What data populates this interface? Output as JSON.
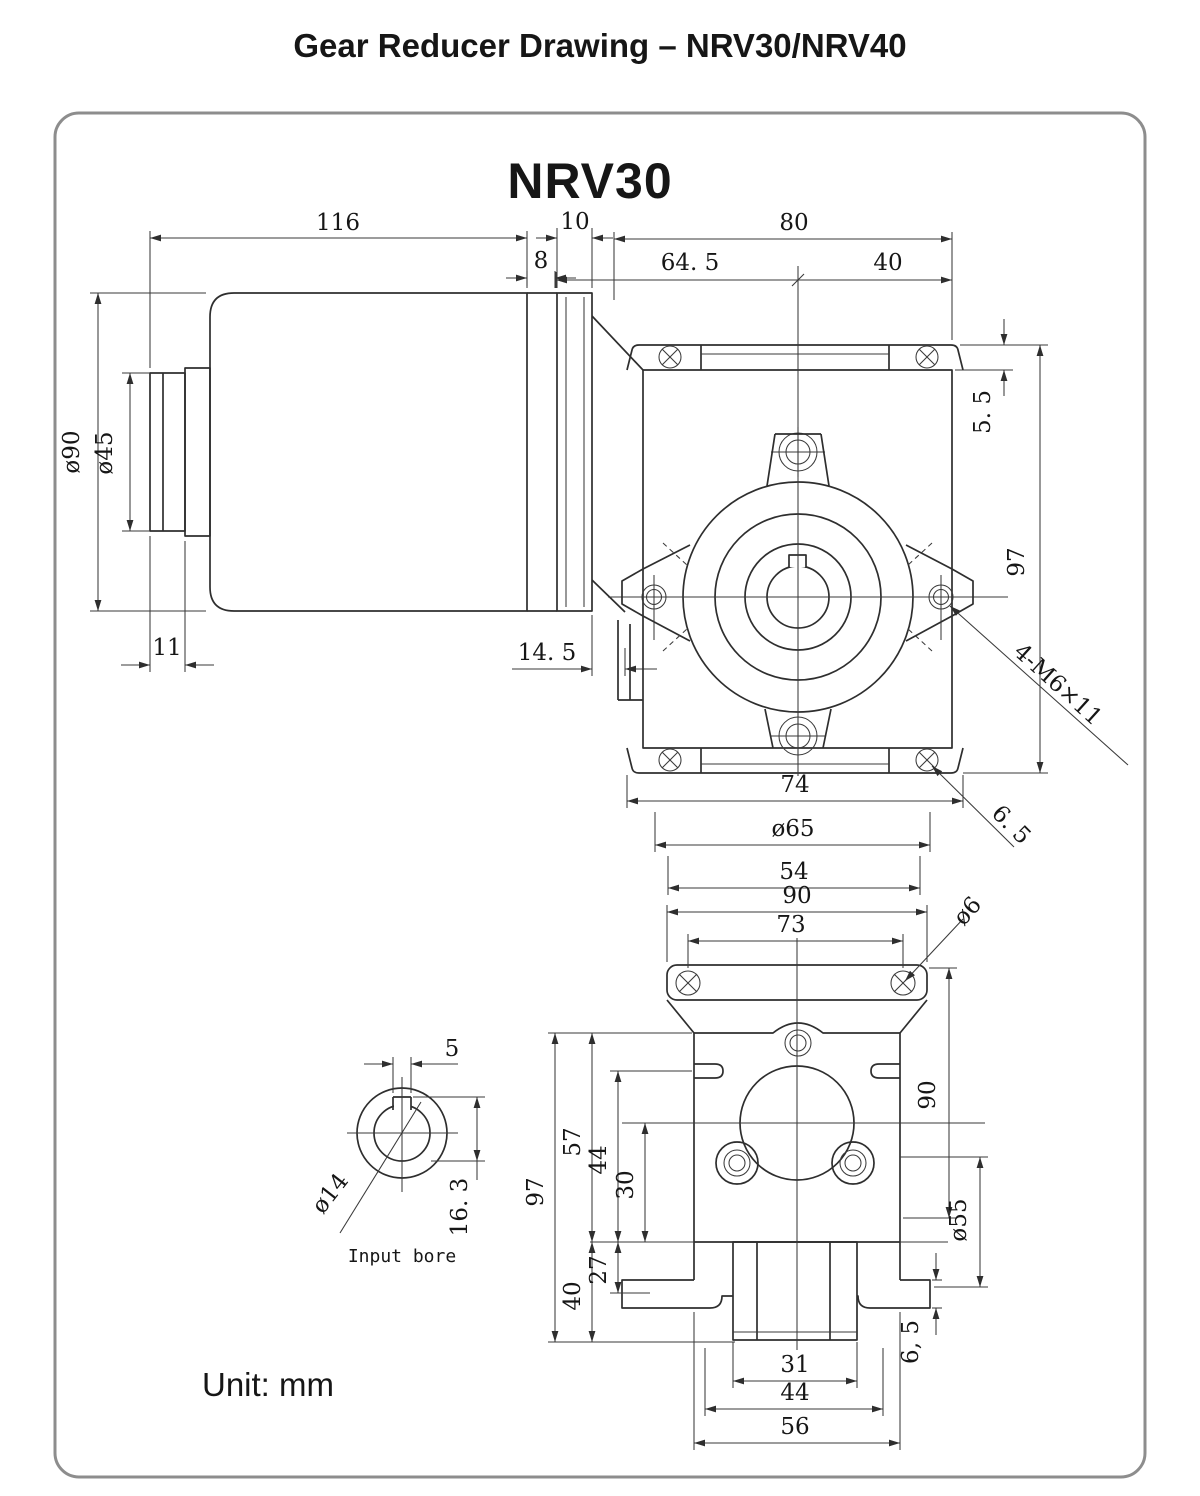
{
  "title": "Gear Reducer Drawing – NRV30/NRV40",
  "model": "NRV30",
  "unit": "Unit: mm",
  "side": {
    "length": "116",
    "flange": "10",
    "gap": "8",
    "motor_dia": "ø90",
    "hub_dia": "ø45",
    "hub_step": "11",
    "face_gap": "14. 5"
  },
  "front": {
    "width": "80",
    "left": "64. 5",
    "right": "40",
    "ear": "5. 5",
    "height": "97",
    "tap": "4-M6×11",
    "hole": "6. 5",
    "span74": "74",
    "dia65": "ø65",
    "span54": "54"
  },
  "bottom": {
    "w90": "90",
    "w73": "73",
    "dia6": "ø6",
    "h90": "90",
    "dia55": "ø55",
    "foot": "6, 5",
    "h97": "97",
    "h57": "57",
    "h44": "44",
    "h30": "30",
    "h27": "27",
    "h40": "40",
    "w31": "31",
    "w44": "44",
    "w56": "56"
  },
  "bore": {
    "key_w": "5",
    "key_d": "16. 3",
    "dia": "ø14",
    "caption": "Input bore"
  }
}
